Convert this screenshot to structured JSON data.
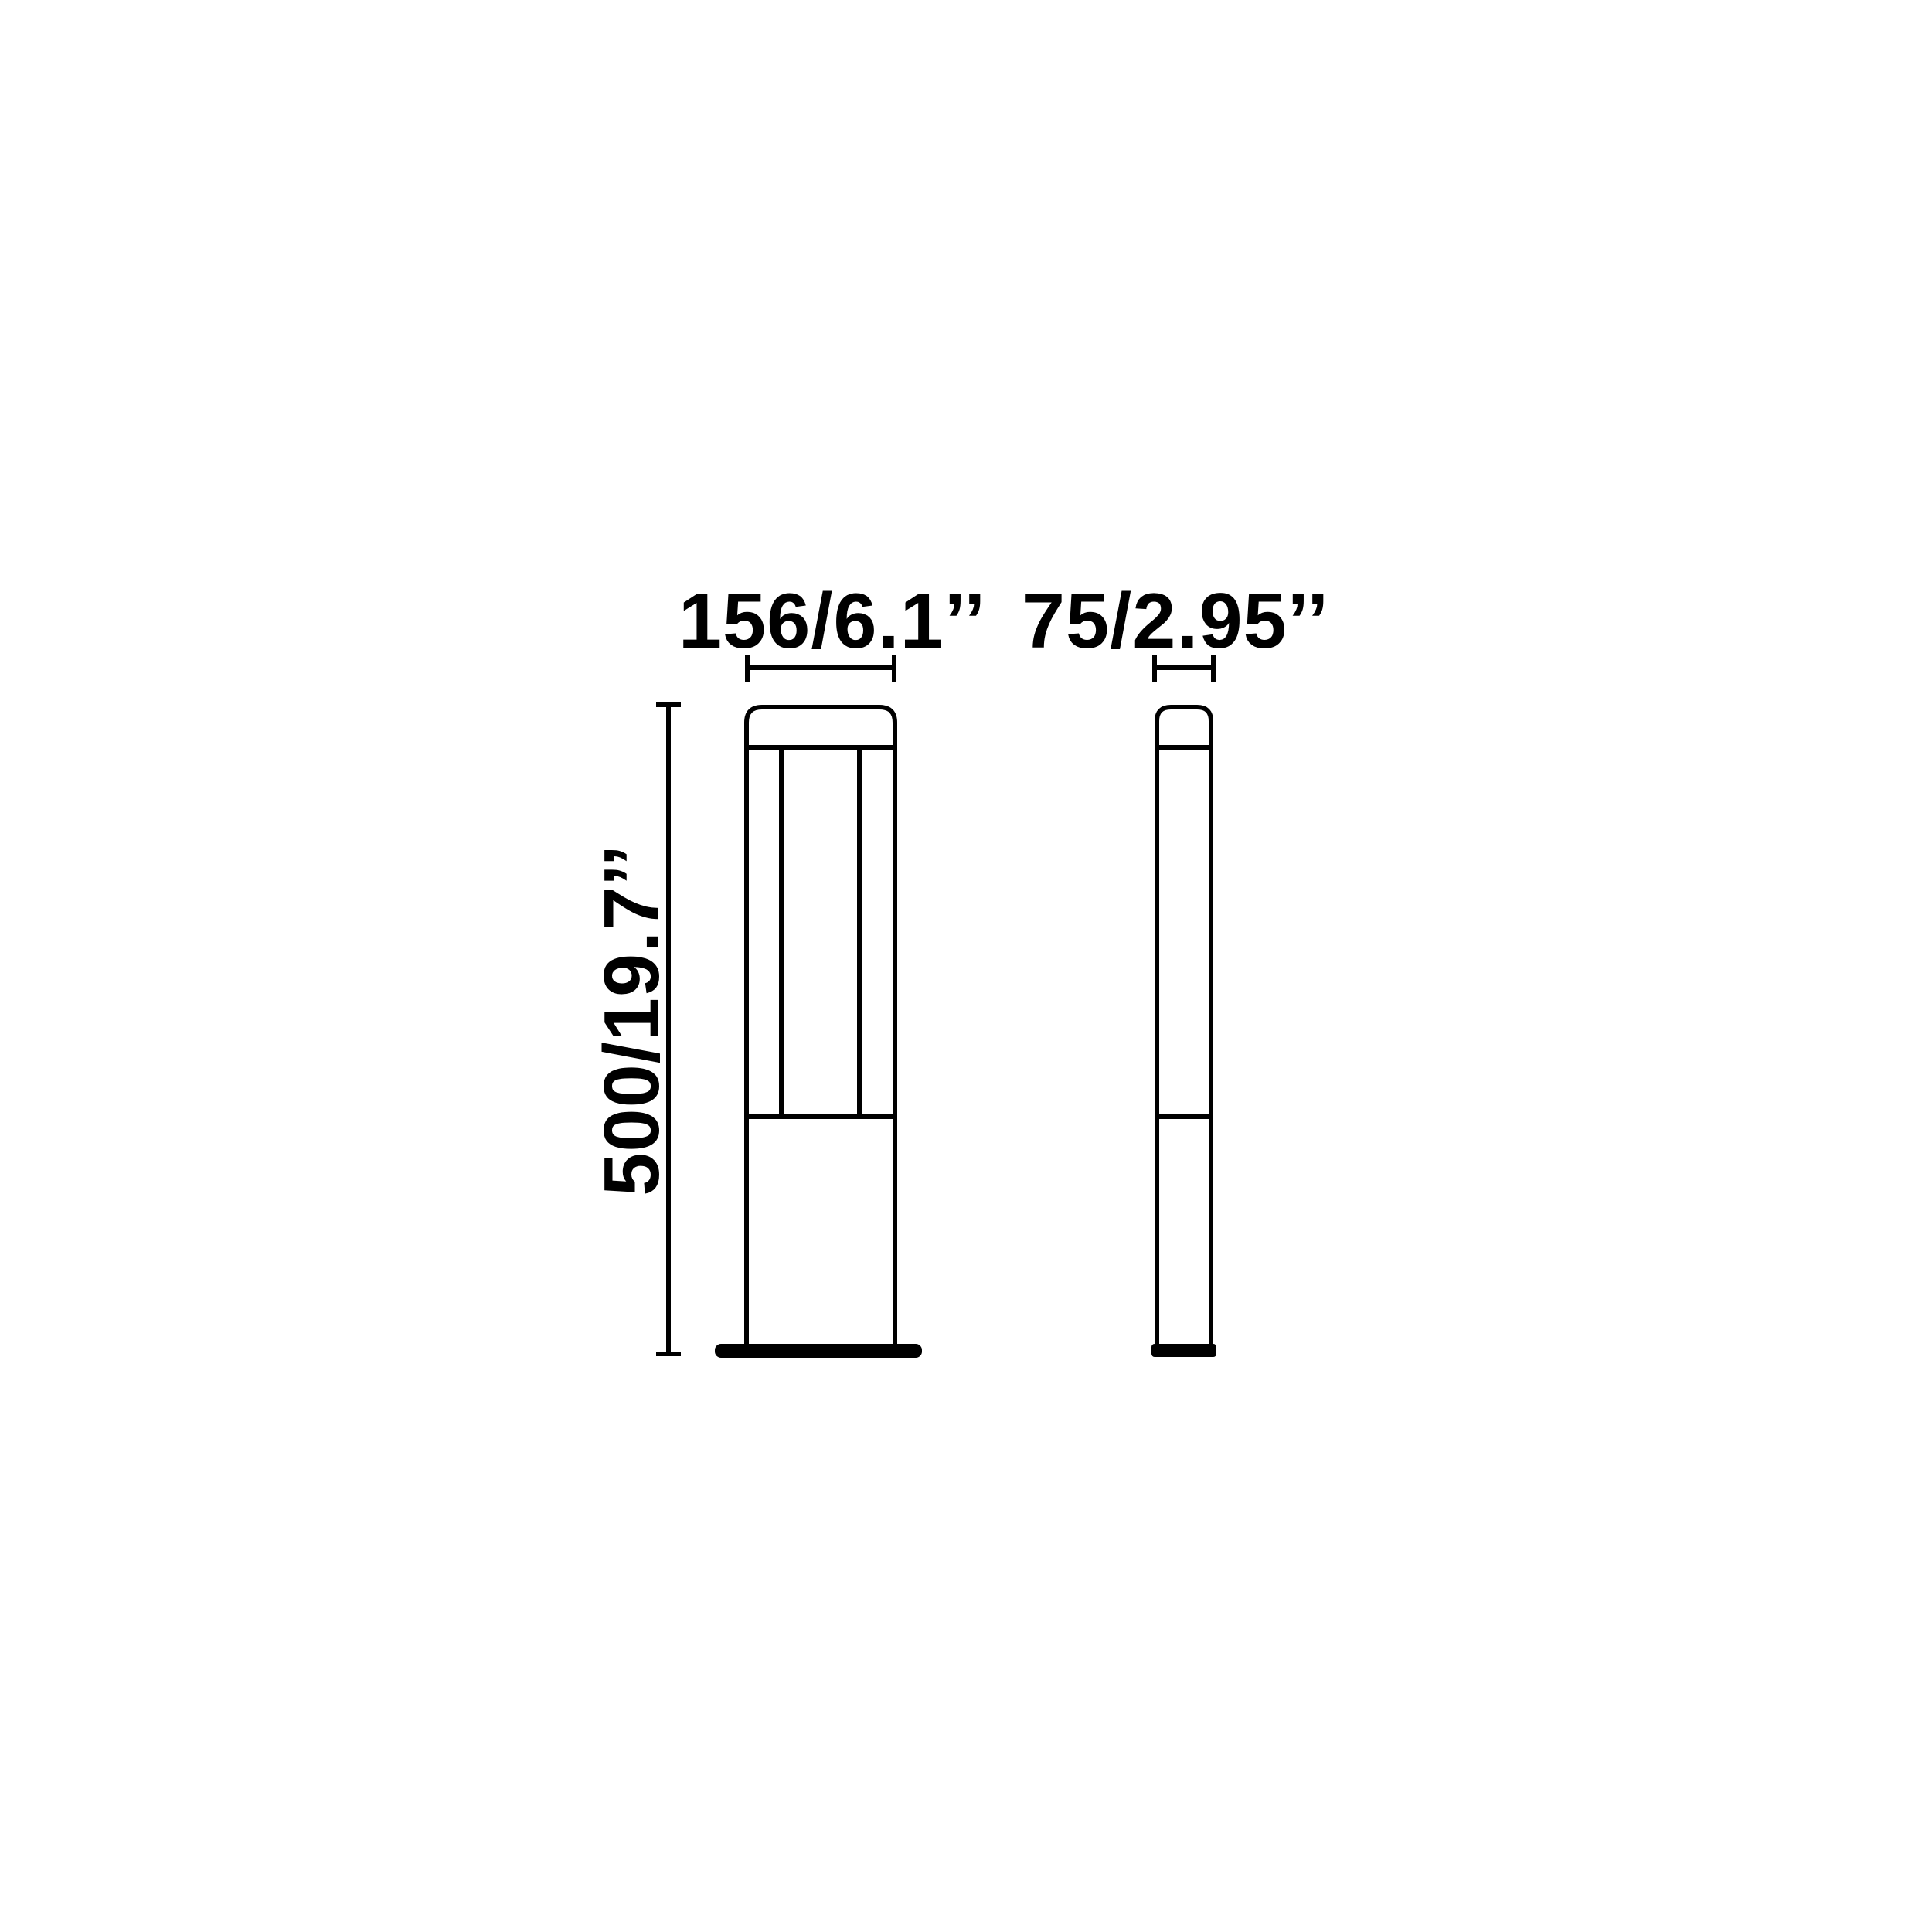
{
  "canvas": {
    "background_color": "#ffffff",
    "line_color": "#000000"
  },
  "drawing": {
    "type": "technical-dimension-diagram",
    "labels": {
      "width": "156/6.1’’",
      "depth": "75/2.95’’",
      "height": "500/19.7’’"
    }
  }
}
